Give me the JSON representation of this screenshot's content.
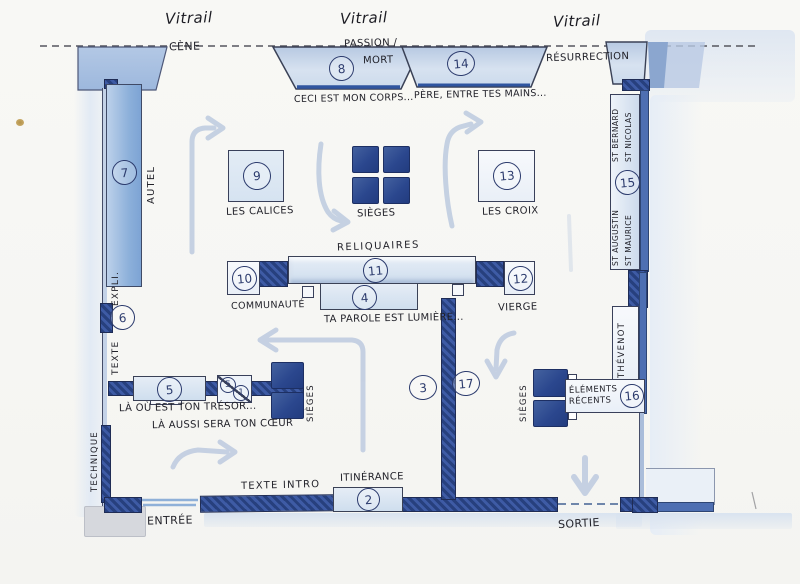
{
  "vitrail": [
    "Vitrail",
    "Vitrail",
    "Vitrail"
  ],
  "zones": {
    "cene": {
      "label": "CÈNE"
    },
    "passion": {
      "line1": "PASSION /",
      "line2": "MORT"
    },
    "resurrection": {
      "label": "RÉSURRECTION"
    },
    "case8": {
      "number": "8",
      "caption": "CECI EST MON CORPS..."
    },
    "case14": {
      "number": "14",
      "caption": "PÈRE, ENTRE TES MAINS..."
    },
    "autel": {
      "number": "7",
      "label": "AUTEL"
    },
    "calices": {
      "number": "9",
      "label": "LES CALICES"
    },
    "sieges_center": {
      "label": "SIÈGES"
    },
    "croix": {
      "number": "13",
      "label": "LES CROIX"
    },
    "reliquaires": {
      "number": "11",
      "label": "RELIQUAIRES"
    },
    "communaute": {
      "number": "10",
      "label": "COMMUNAUTÉ"
    },
    "vierge": {
      "number": "12",
      "label": "VIERGE"
    },
    "parole": {
      "number": "4",
      "caption": "TA PAROLE EST LUMIÈRE..."
    },
    "texte_expo": {
      "number": "6",
      "label_upper": "EXPLI.",
      "label_lower": "TEXTE"
    },
    "tresor": {
      "number": "5",
      "combo_top": "5",
      "combo_bottom": "1",
      "caption1": "LÀ OÙ EST TON TRÉSOR...",
      "caption2": "LÀ AUSSI SERA TON CŒUR",
      "sieges_label": "SIÈGES"
    },
    "zone3": {
      "number": "3"
    },
    "zone17": {
      "number": "17"
    },
    "saints": {
      "number": "15",
      "top_line1": "ST BERNARD",
      "top_line2": "ST NICOLAS",
      "bottom_line1": "ST AUGUSTIN",
      "bottom_line2": "ST MAURICE"
    },
    "thevenot": {
      "label": "THÉVENOT"
    },
    "recents": {
      "number": "16",
      "line1": "ÉLÉMENTS",
      "line2": "RÉCENTS",
      "sieges_label": "SIÈGES"
    },
    "itinerance": {
      "number": "2",
      "label": "ITINÉRANCE"
    },
    "texte_intro": {
      "label": "TEXTE INTRO"
    },
    "technique": {
      "label": "TECHNIQUE"
    },
    "entree": {
      "label": "ENTRÉE"
    },
    "sortie": {
      "label": "SORTIE"
    }
  },
  "colors": {
    "wall_dark": "#2a4385",
    "wall_mid": "#4e6fb2",
    "fill_light": "#cddcee",
    "arrow": "#c3cfe2",
    "ink": "#32323c",
    "number_ink": "#2d3c6e"
  }
}
